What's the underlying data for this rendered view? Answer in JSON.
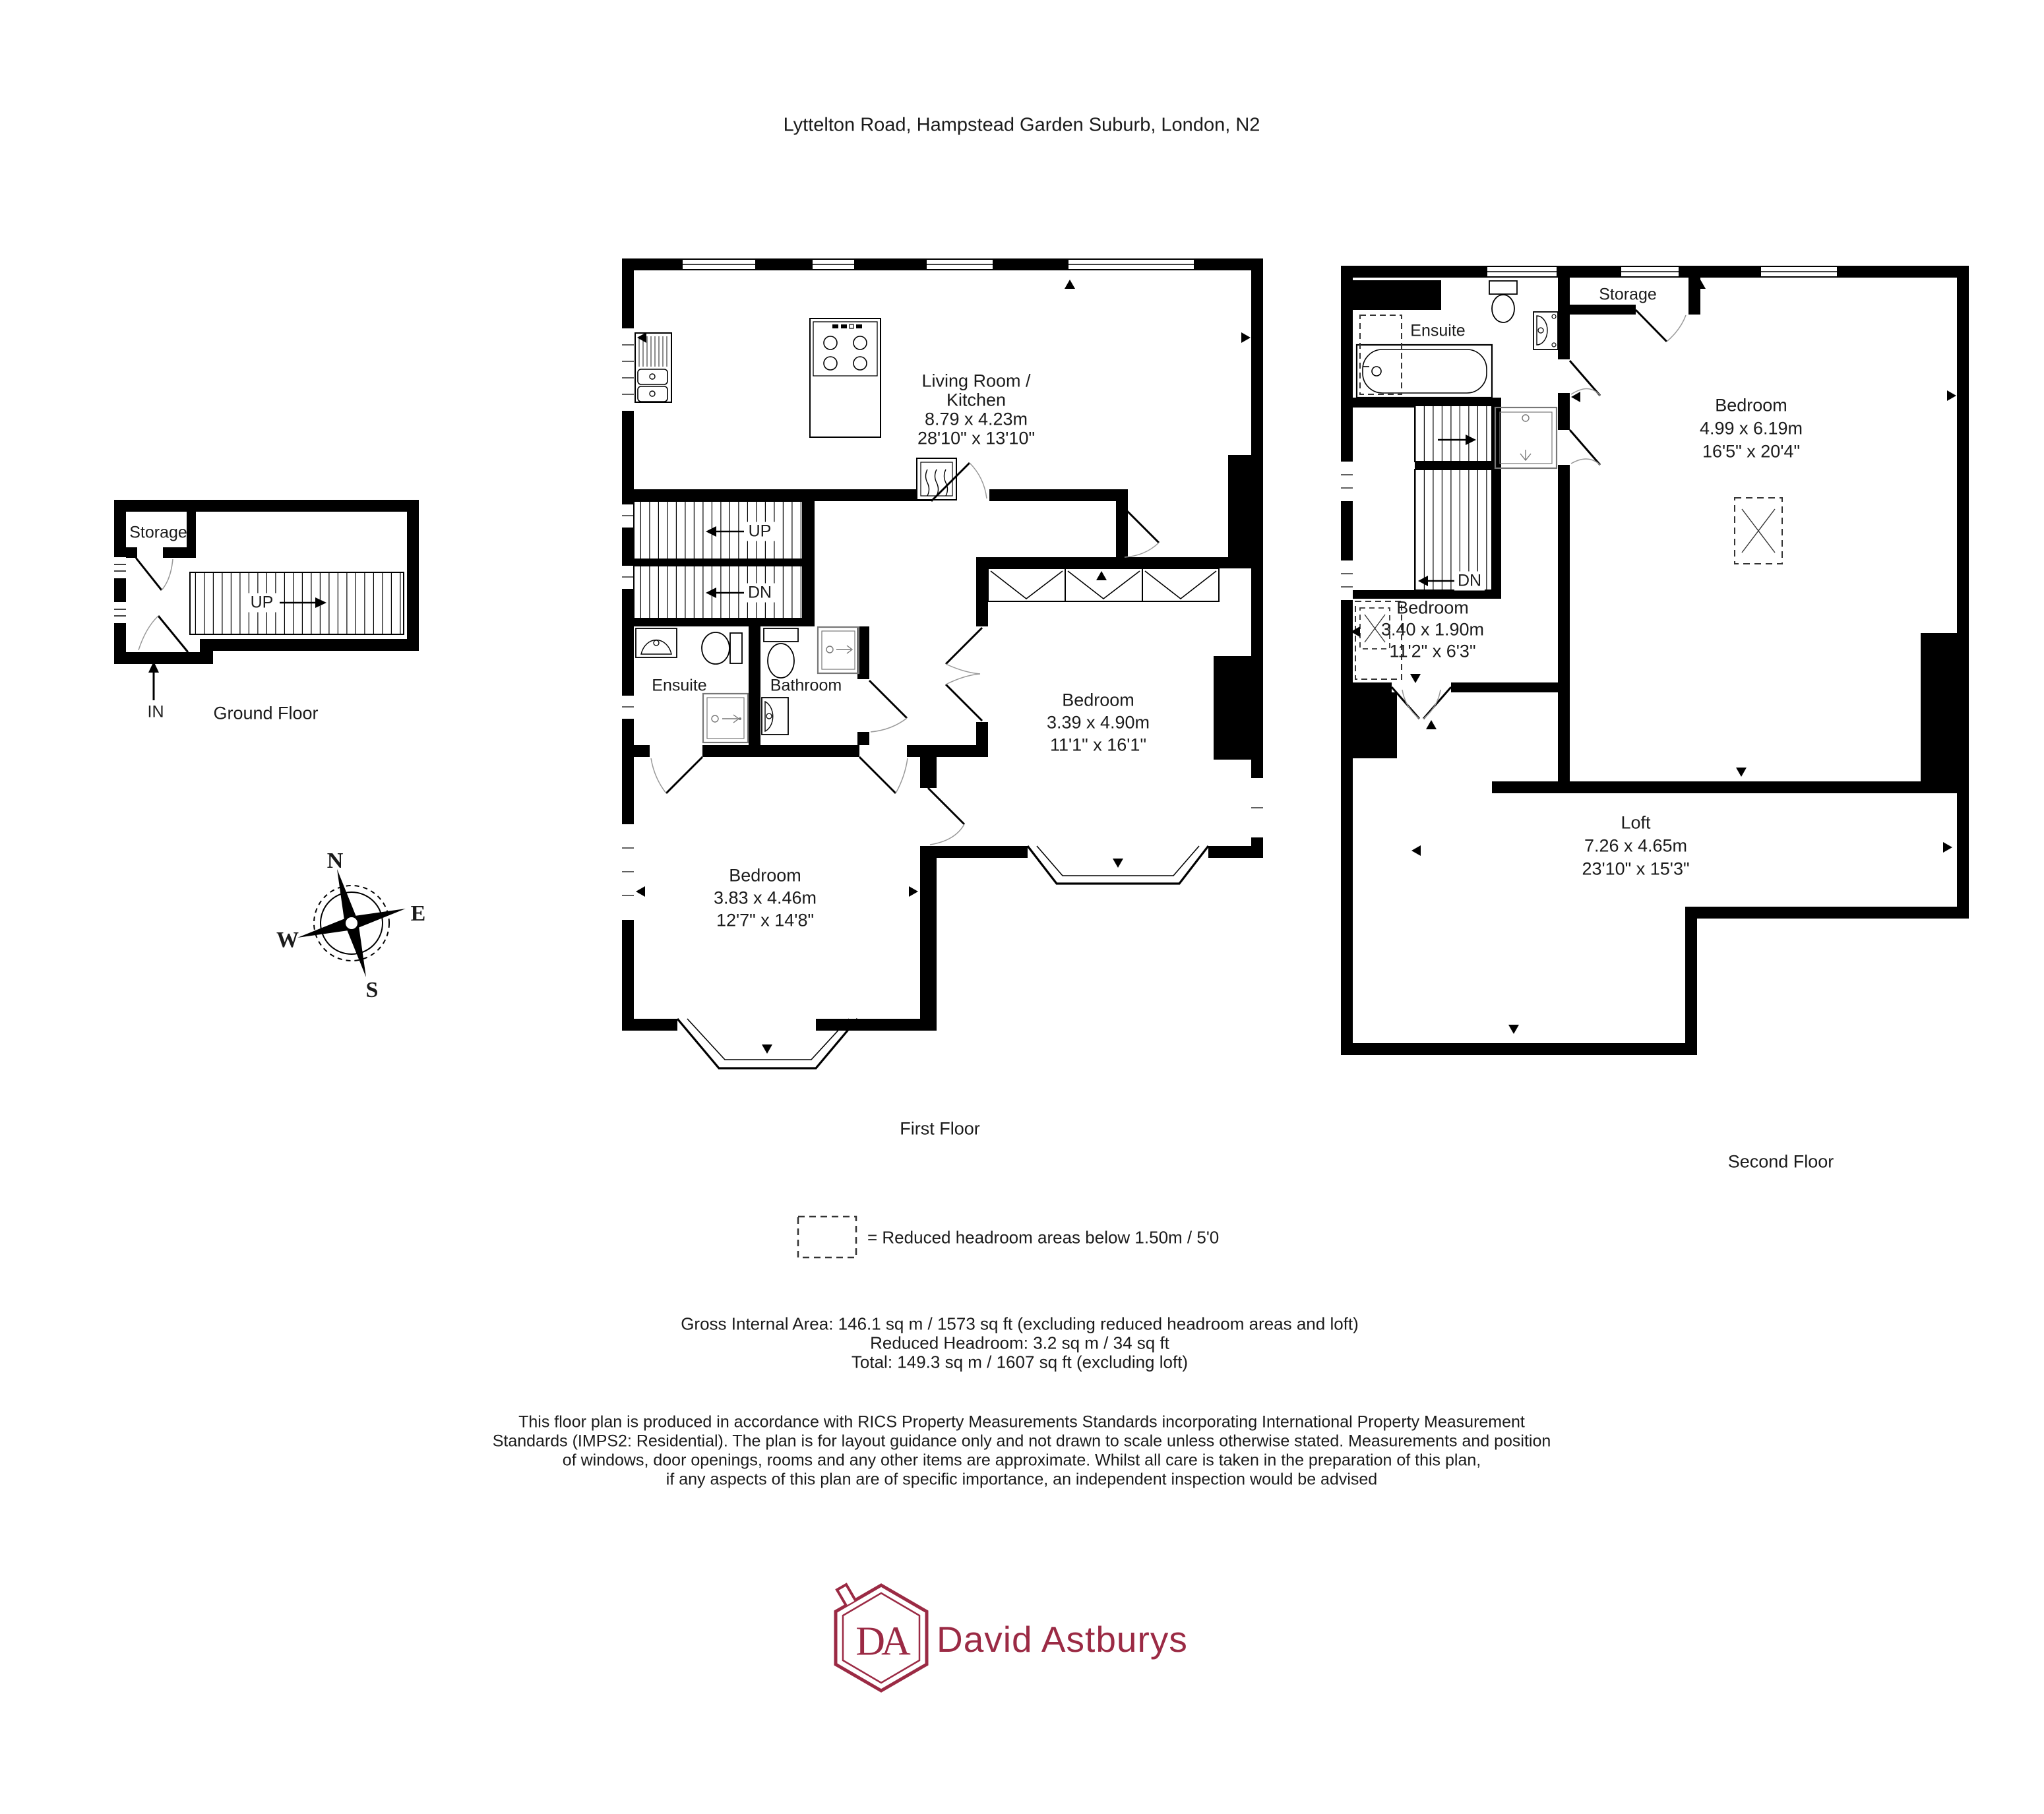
{
  "title": "Lyttelton Road, Hampstead Garden Suburb, London, N2",
  "compass": {
    "north": "N",
    "east": "E",
    "south": "S",
    "west": "W"
  },
  "floors": {
    "ground": {
      "label": "Ground Floor",
      "rooms": {
        "storage": "Storage"
      },
      "stairs": {
        "up": "UP"
      },
      "entrance": "IN"
    },
    "first": {
      "label": "First Floor",
      "stairs": {
        "up": "UP",
        "dn": "DN"
      },
      "rooms": {
        "living": {
          "name_line1": "Living Room /",
          "name_line2": "Kitchen",
          "metric": "8.79 x 4.23m",
          "imperial": "28'10\" x 13'10\""
        },
        "ensuite": {
          "name": "Ensuite"
        },
        "bathroom": {
          "name": "Bathroom"
        },
        "bedroom_right": {
          "name": "Bedroom",
          "metric": "3.39 x 4.90m",
          "imperial": "11'1\" x 16'1\""
        },
        "bedroom_left": {
          "name": "Bedroom",
          "metric": "3.83 x 4.46m",
          "imperial": "12'7\" x 14'8\""
        }
      }
    },
    "second": {
      "label": "Second Floor",
      "stairs": {
        "dn": "DN"
      },
      "rooms": {
        "ensuite": {
          "name": "Ensuite"
        },
        "storage": {
          "name": "Storage"
        },
        "bedroom_main": {
          "name": "Bedroom",
          "metric": "4.99 x 6.19m",
          "imperial": "16'5\" x 20'4\""
        },
        "bedroom_small": {
          "name": "Bedroom",
          "metric": "3.40 x 1.90m",
          "imperial": "11'2\" x 6'3\""
        },
        "loft": {
          "name": "Loft",
          "metric": "7.26 x 4.65m",
          "imperial": "23'10\" x 15'3\""
        }
      }
    }
  },
  "legend": {
    "reduced_headroom": "= Reduced headroom areas below 1.50m / 5'0"
  },
  "areas": {
    "gross": "Gross Internal Area: 146.1 sq m / 1573 sq ft (excluding reduced headroom areas and loft)",
    "reduced": "Reduced Headroom: 3.2 sq m / 34 sq ft",
    "total": "Total: 149.3 sq m / 1607 sq ft (excluding loft)"
  },
  "disclaimer": {
    "line1": "This floor plan is produced in accordance with RICS Property Measurements Standards incorporating International Property Measurement",
    "line2": "Standards (IMPS2: Residential). The plan is for layout guidance only and not drawn to scale unless otherwise stated. Measurements and position",
    "line3": "of windows, door openings, rooms and any other items are approximate. Whilst all care is taken in the preparation of this plan,",
    "line4": "if any aspects of this plan are of specific importance, an independent inspection would be advised"
  },
  "logo": {
    "initials": "DA",
    "name": "David Astburys",
    "color": "#9b2a44"
  }
}
